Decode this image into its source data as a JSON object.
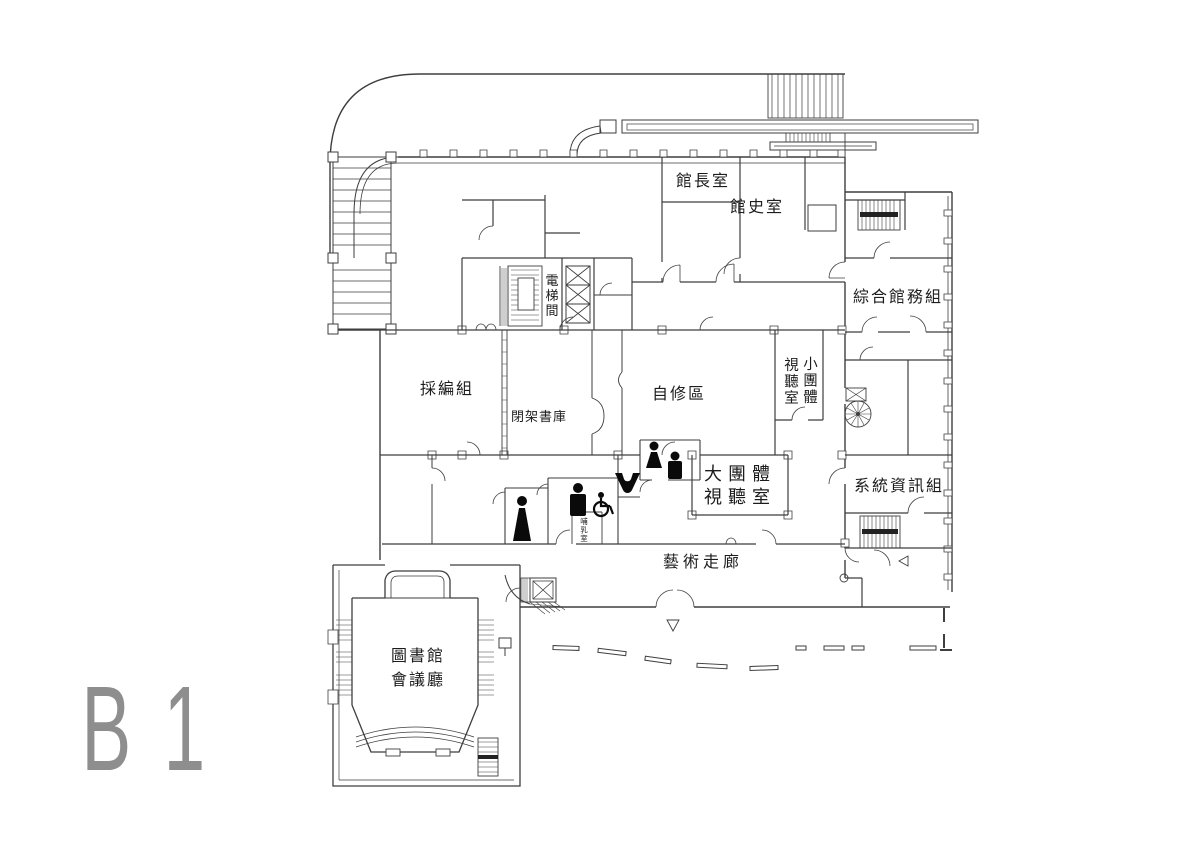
{
  "floor": {
    "label": "B1"
  },
  "palette": {
    "wall_line": "#3e3e3e",
    "detail_line": "#555555",
    "floor_label_gray": "#8e8e8e",
    "icon_black": "#0a0a0a",
    "background": "#ffffff"
  },
  "rooms": {
    "director_office": "館長室",
    "history_room": "館史室",
    "general_services_division": "綜合館務組",
    "elevator_hall": "電梯間",
    "acquisitions_division": "採編組",
    "self_study_area": "自修區",
    "small_av_room_col_right": "小團體",
    "small_av_room_col_left": "視聽室",
    "closed_stacks": "閉架書庫",
    "large_av_room_line1": "大團體",
    "large_av_room_line2": "視聽室",
    "systems_information_division": "系統資訊組",
    "art_corridor": "藝術走廊",
    "conference_hall_line1": "圖書館",
    "conference_hall_line2": "會議廳",
    "nursing_room": "哺乳室"
  },
  "icons": {
    "female_restroom": "woman-figure",
    "male_restroom": "man-figure",
    "accessible_restroom": "wheelchair",
    "urinal": "toilet-bowl",
    "elevator_shaft": "crossed-box",
    "spiral_staircase": "spiral",
    "staircase": "hatched-treads"
  }
}
